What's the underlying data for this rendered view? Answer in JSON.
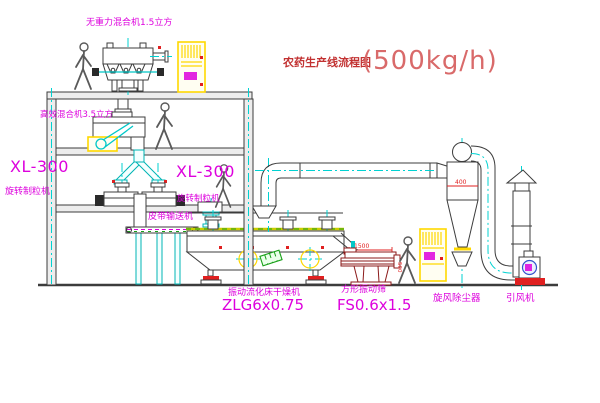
{
  "title": {
    "text": "农药生产线流程图",
    "capacity": "(500kg/h)"
  },
  "labels": {
    "top_mixer": "无重力混合机1.5立方",
    "floor2_mixer": "高效混合机3.5立方",
    "granulator_left_model": "XL-300",
    "granulator_left_name": "旋转制粒机",
    "granulator_right_model": "XL-300",
    "granulator_right_name": "旋转制粒机",
    "belt_conveyor": "皮带输送机",
    "dryer_name": "振动流化床干燥机",
    "dryer_model": "ZLG6x0.75",
    "sieve_name": "方形振动筛",
    "sieve_model": "FS0.6x1.5",
    "cyclone_name": "旋风除尘器",
    "fan_name": "引风机"
  },
  "dimensions": {
    "cyclone": "400",
    "sieve_length": "1500",
    "sieve_height": "500"
  },
  "colors": {
    "label_magenta": "#dd00dd",
    "title_red": "#c23232",
    "capacity_red": "#d96a6a",
    "dimension_red": "#e02020",
    "centerline_cyan": "#00d2d2",
    "cabinet_yellow": "#ffd800",
    "motor_green": "#18a018",
    "sieve_maroon": "#8b1a1a",
    "line_dark": "#3c3c3c"
  }
}
